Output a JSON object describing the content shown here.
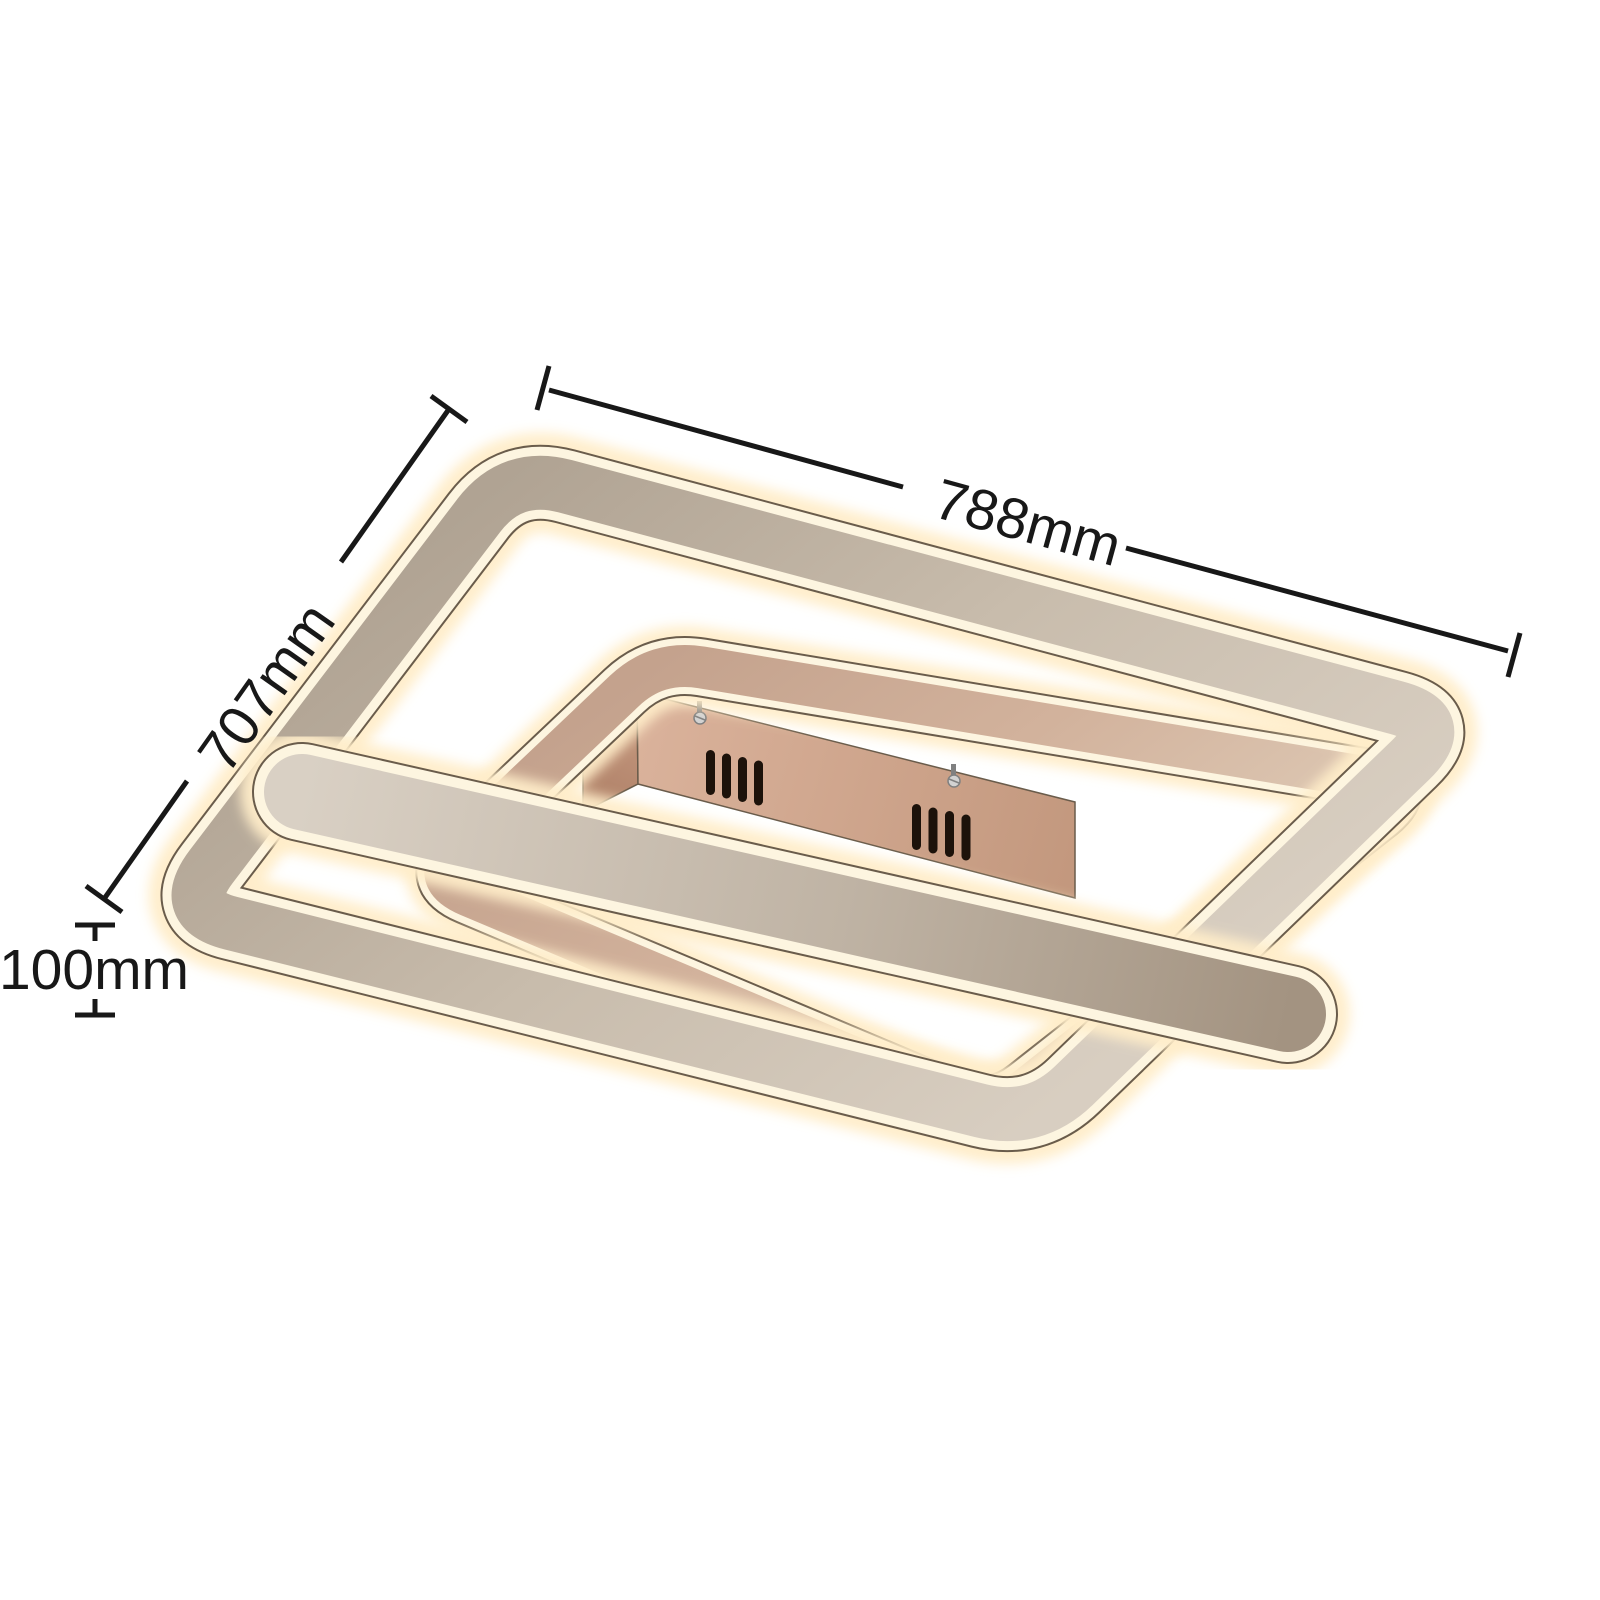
{
  "image": {
    "description": "Dimension diagram of a square LED ceiling light with two nested square light frames and a crossing light bar, shown from below at an angle",
    "background": "#ffffff"
  },
  "dimensions": {
    "width": "788mm",
    "depth": "707mm",
    "height": "100mm"
  },
  "colors": {
    "background": "#ffffff",
    "dimension_line": "#181818",
    "led_glow": "#ffedc9",
    "led_rim": "#fdf5e0",
    "edge_line": "#6a5c4b",
    "outer_metal_a": "#b0a393",
    "outer_metal_b": "#c8bcac",
    "outer_metal_c": "#d8cec1",
    "inner_metal_a": "#c4a28d",
    "inner_metal_b": "#d2b29c",
    "inner_metal_c": "#decab6",
    "bar_metal_a": "#d9d0c4",
    "bar_metal_b": "#bfb3a4",
    "bar_metal_c": "#a39381",
    "canopy_a": "#dab29b",
    "canopy_b": "#c3987e",
    "canopy_side_a": "#c79a81",
    "canopy_side_b": "#ad7f66",
    "vent_slot": "#1c120a",
    "screw_light": "#d2d2d2",
    "screw_dark": "#808080"
  }
}
